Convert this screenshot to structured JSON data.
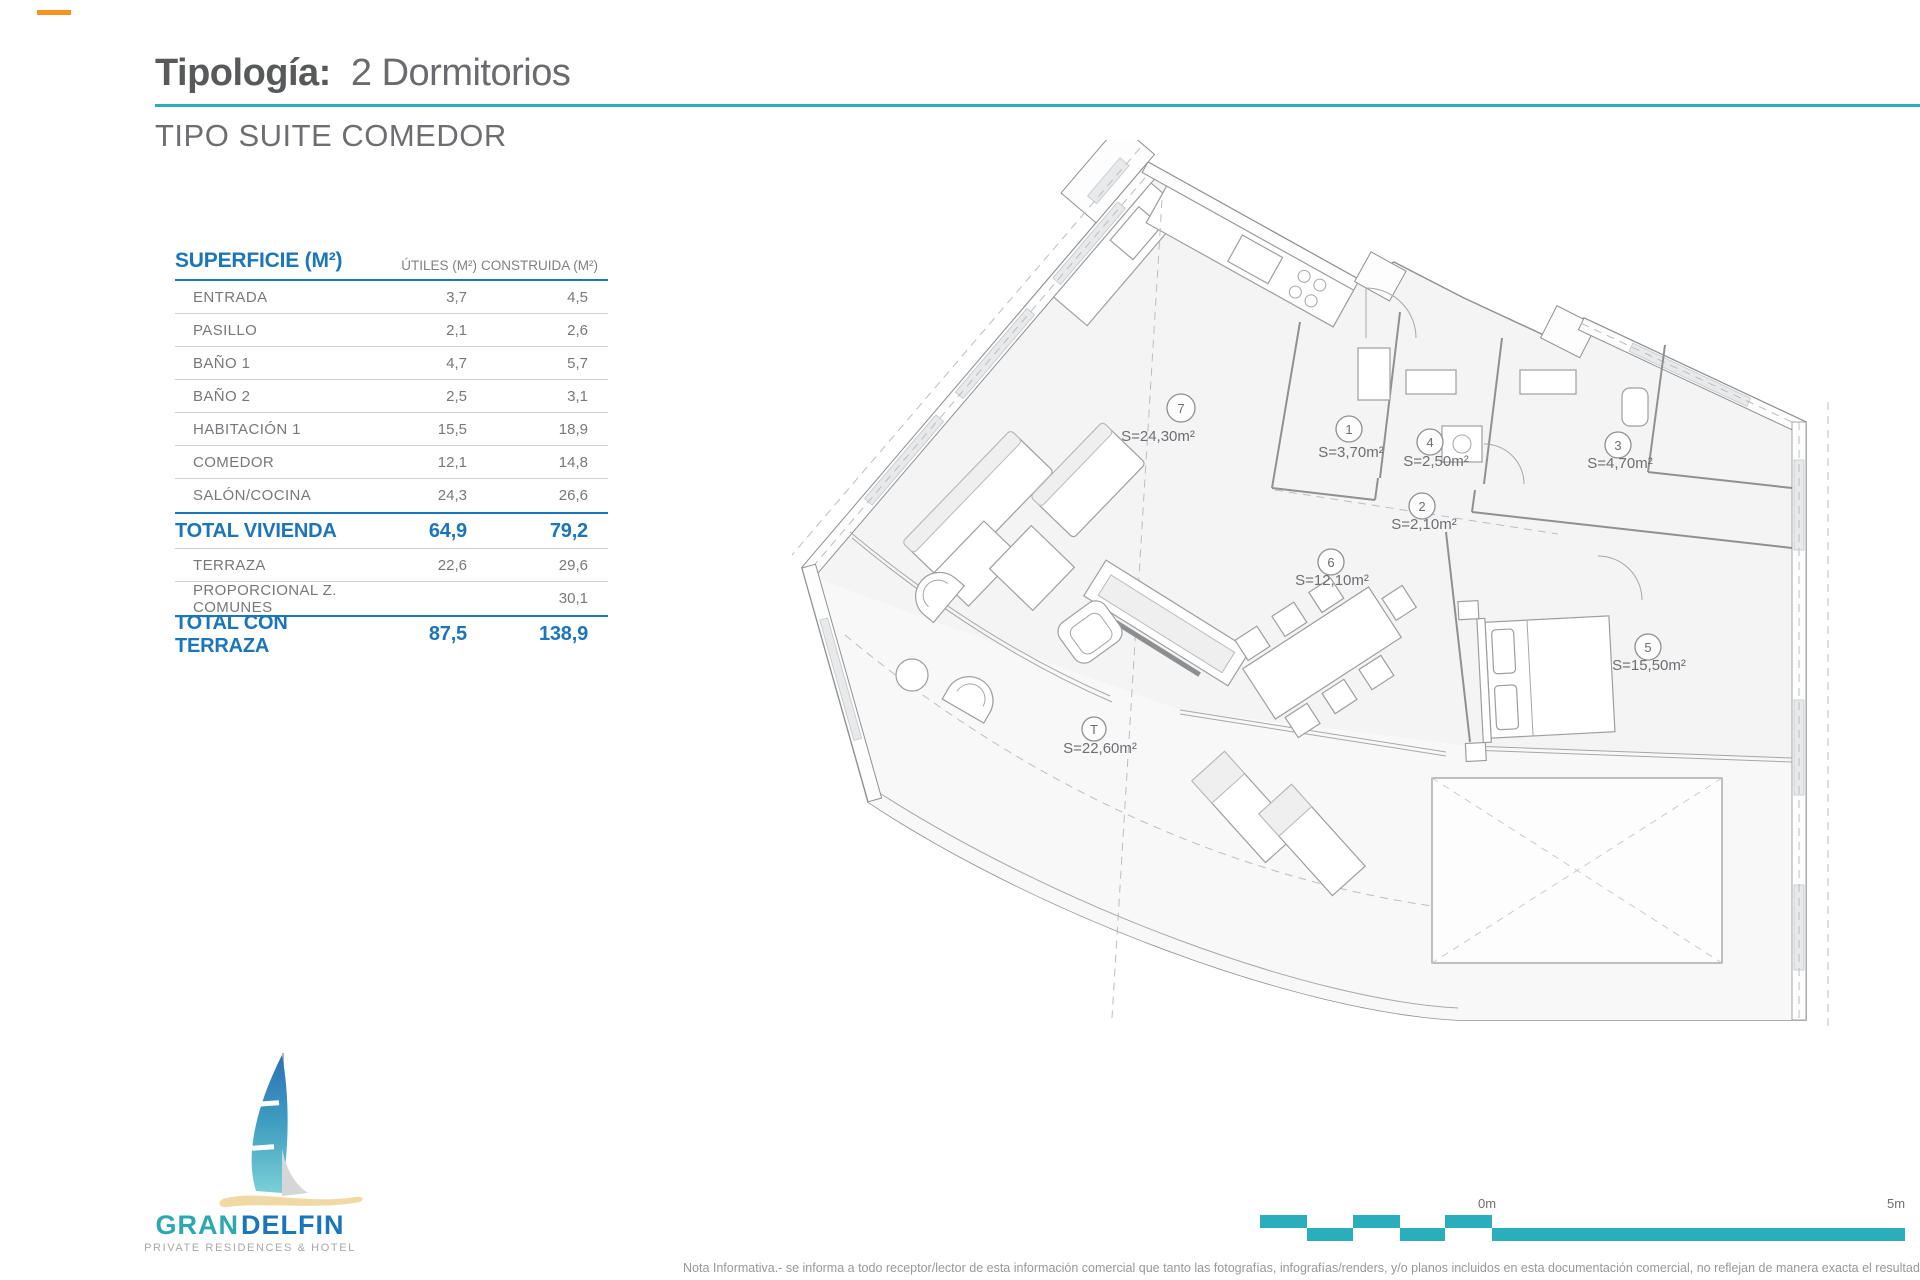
{
  "header": {
    "title_label": "Tipología:",
    "title_value": "2 Dormitorios",
    "subtitle": "TIPO SUITE COMEDOR"
  },
  "surface_table": {
    "col_surface": "SUPERFICIE (M²)",
    "col_utiles": "ÚTILES (M²)",
    "col_construida": "CONSTRUIDA (M²)",
    "rows": [
      {
        "label": "ENTRADA",
        "utiles": "3,7",
        "construida": "4,5"
      },
      {
        "label": "PASILLO",
        "utiles": "2,1",
        "construida": "2,6"
      },
      {
        "label": "BAÑO 1",
        "utiles": "4,7",
        "construida": "5,7"
      },
      {
        "label": "BAÑO 2",
        "utiles": "2,5",
        "construida": "3,1"
      },
      {
        "label": "HABITACIÓN 1",
        "utiles": "15,5",
        "construida": "18,9"
      },
      {
        "label": "COMEDOR",
        "utiles": "12,1",
        "construida": "14,8"
      },
      {
        "label": "SALÓN/COCINA",
        "utiles": "24,3",
        "construida": "26,6"
      }
    ],
    "total_vivienda": {
      "label": "TOTAL VIVIENDA",
      "utiles": "64,9",
      "construida": "79,2"
    },
    "terraza": {
      "label": "TERRAZA",
      "utiles": "22,6",
      "construida": "29,6"
    },
    "comunes": {
      "label": "PROPORCIONAL Z. COMUNES",
      "utiles": "",
      "construida": "30,1"
    },
    "total_terraza": {
      "label": "TOTAL CON TERRAZA",
      "utiles": "87,5",
      "construida": "138,9"
    }
  },
  "floorplan": {
    "rooms": [
      {
        "id": "7",
        "area": "S=24,30m²"
      },
      {
        "id": "1",
        "area": "S=3,70m²"
      },
      {
        "id": "4",
        "area": "S=2,50m²"
      },
      {
        "id": "3",
        "area": "S=4,70m²"
      },
      {
        "id": "2",
        "area": "S=2,10m²"
      },
      {
        "id": "6",
        "area": "S=12,10m²"
      },
      {
        "id": "5",
        "area": "S=15,50m²"
      },
      {
        "id": "T",
        "area": "S=22,60m²"
      }
    ],
    "scale": {
      "zero": "0m",
      "five": "5m"
    }
  },
  "logo": {
    "gran": "GRAN",
    "delfin": "DELFIN",
    "tagline": "PRIVATE RESIDENCES & HOTEL"
  },
  "footer": {
    "note": "Nota Informativa.- se informa a todo receptor/lector de esta información comercial que tanto las fotografías, infografías/renders, y/o planos incluidos en esta documentación comercial, no reflejan de manera exacta el resultado final del"
  },
  "colors": {
    "accent_teal": "#2BAEBC",
    "brand_blue": "#1B75BB",
    "text_gray": "#77787B",
    "title_gray": "#58595B",
    "sand": "#F1D9A5"
  }
}
